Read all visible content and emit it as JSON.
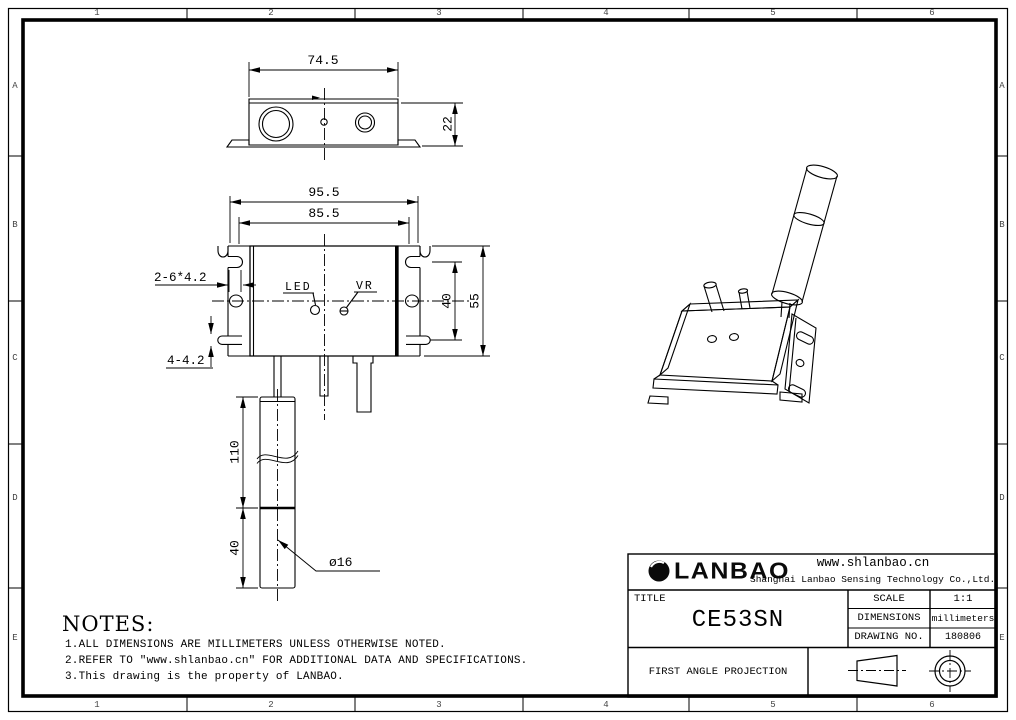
{
  "frame": {
    "cols": [
      "1",
      "2",
      "3",
      "4",
      "5",
      "6"
    ],
    "rows": [
      "A",
      "B",
      "C",
      "D",
      "E"
    ]
  },
  "top_view": {
    "width": "74.5",
    "height": "22"
  },
  "front_view": {
    "overall_width": "95.5",
    "body_width": "85.5",
    "slot_spacing": "40",
    "body_height": "55",
    "side_slots": "2-6*4.2",
    "bottom_slots": "4-4.2",
    "led_label": "LED",
    "vr_label": "VR"
  },
  "sensor": {
    "cable_length": "110",
    "head_length": "40",
    "diameter": "ø16"
  },
  "notes": {
    "heading": "NOTES:",
    "items": [
      "1.ALL DIMENSIONS ARE MILLIMETERS UNLESS OTHERWISE NOTED.",
      "2.REFER TO ″www.shlanbao.cn″ FOR ADDITIONAL DATA AND SPECIFICATIONS.",
      "3.This drawing is the property of LANBAO."
    ]
  },
  "title_block": {
    "logo_text": "LANBAO",
    "website": "www.shlanbao.cn",
    "company": "Shanghai Lanbao Sensing Technology Co.,Ltd.",
    "title_label": "TITLE",
    "title_value": "CE53SN",
    "scale_label": "SCALE",
    "scale_value": "1:1",
    "dimensions_label": "DIMENSIONS",
    "dimensions_value": "millimeters",
    "drawing_no_label": "DRAWING NO.",
    "drawing_no_value": "180806",
    "projection_label": "FIRST ANGLE PROJECTION"
  }
}
